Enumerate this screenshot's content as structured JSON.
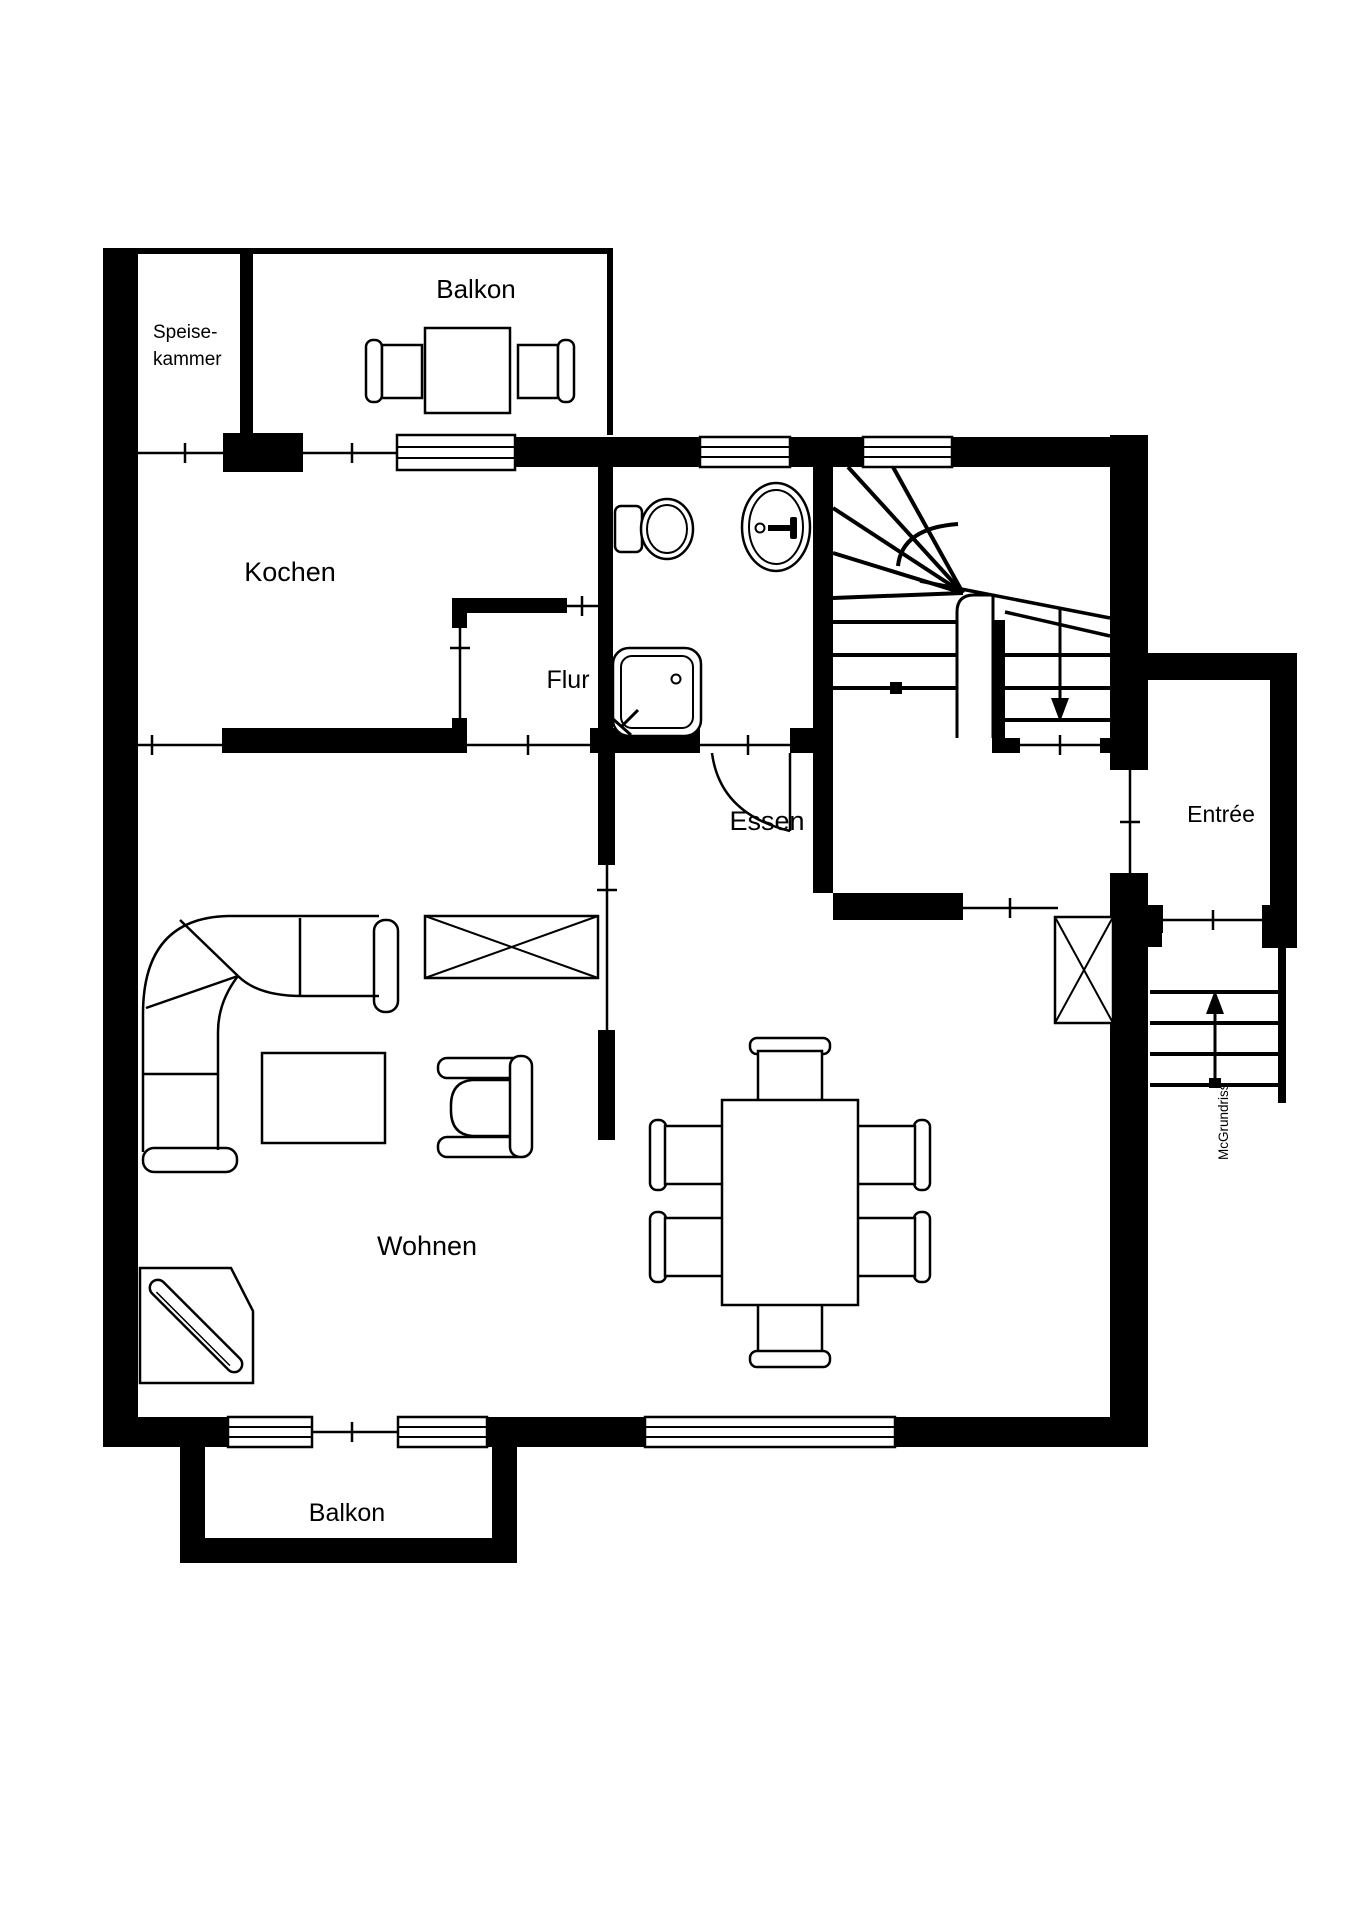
{
  "floorplan": {
    "watermark": "McGrundriss",
    "colors": {
      "wall": "#000000",
      "background": "#ffffff",
      "line": "#000000"
    },
    "rooms": [
      {
        "id": "balkon-top",
        "label": "Balkon"
      },
      {
        "id": "speisekammer",
        "label_line1": "Speise-",
        "label_line2": "kammer"
      },
      {
        "id": "kochen",
        "label": "Kochen"
      },
      {
        "id": "flur",
        "label": "Flur"
      },
      {
        "id": "entree",
        "label": "Entrée"
      },
      {
        "id": "essen",
        "label": "Essen"
      },
      {
        "id": "wohnen",
        "label": "Wohnen"
      },
      {
        "id": "balkon-bottom",
        "label": "Balkon"
      }
    ]
  }
}
